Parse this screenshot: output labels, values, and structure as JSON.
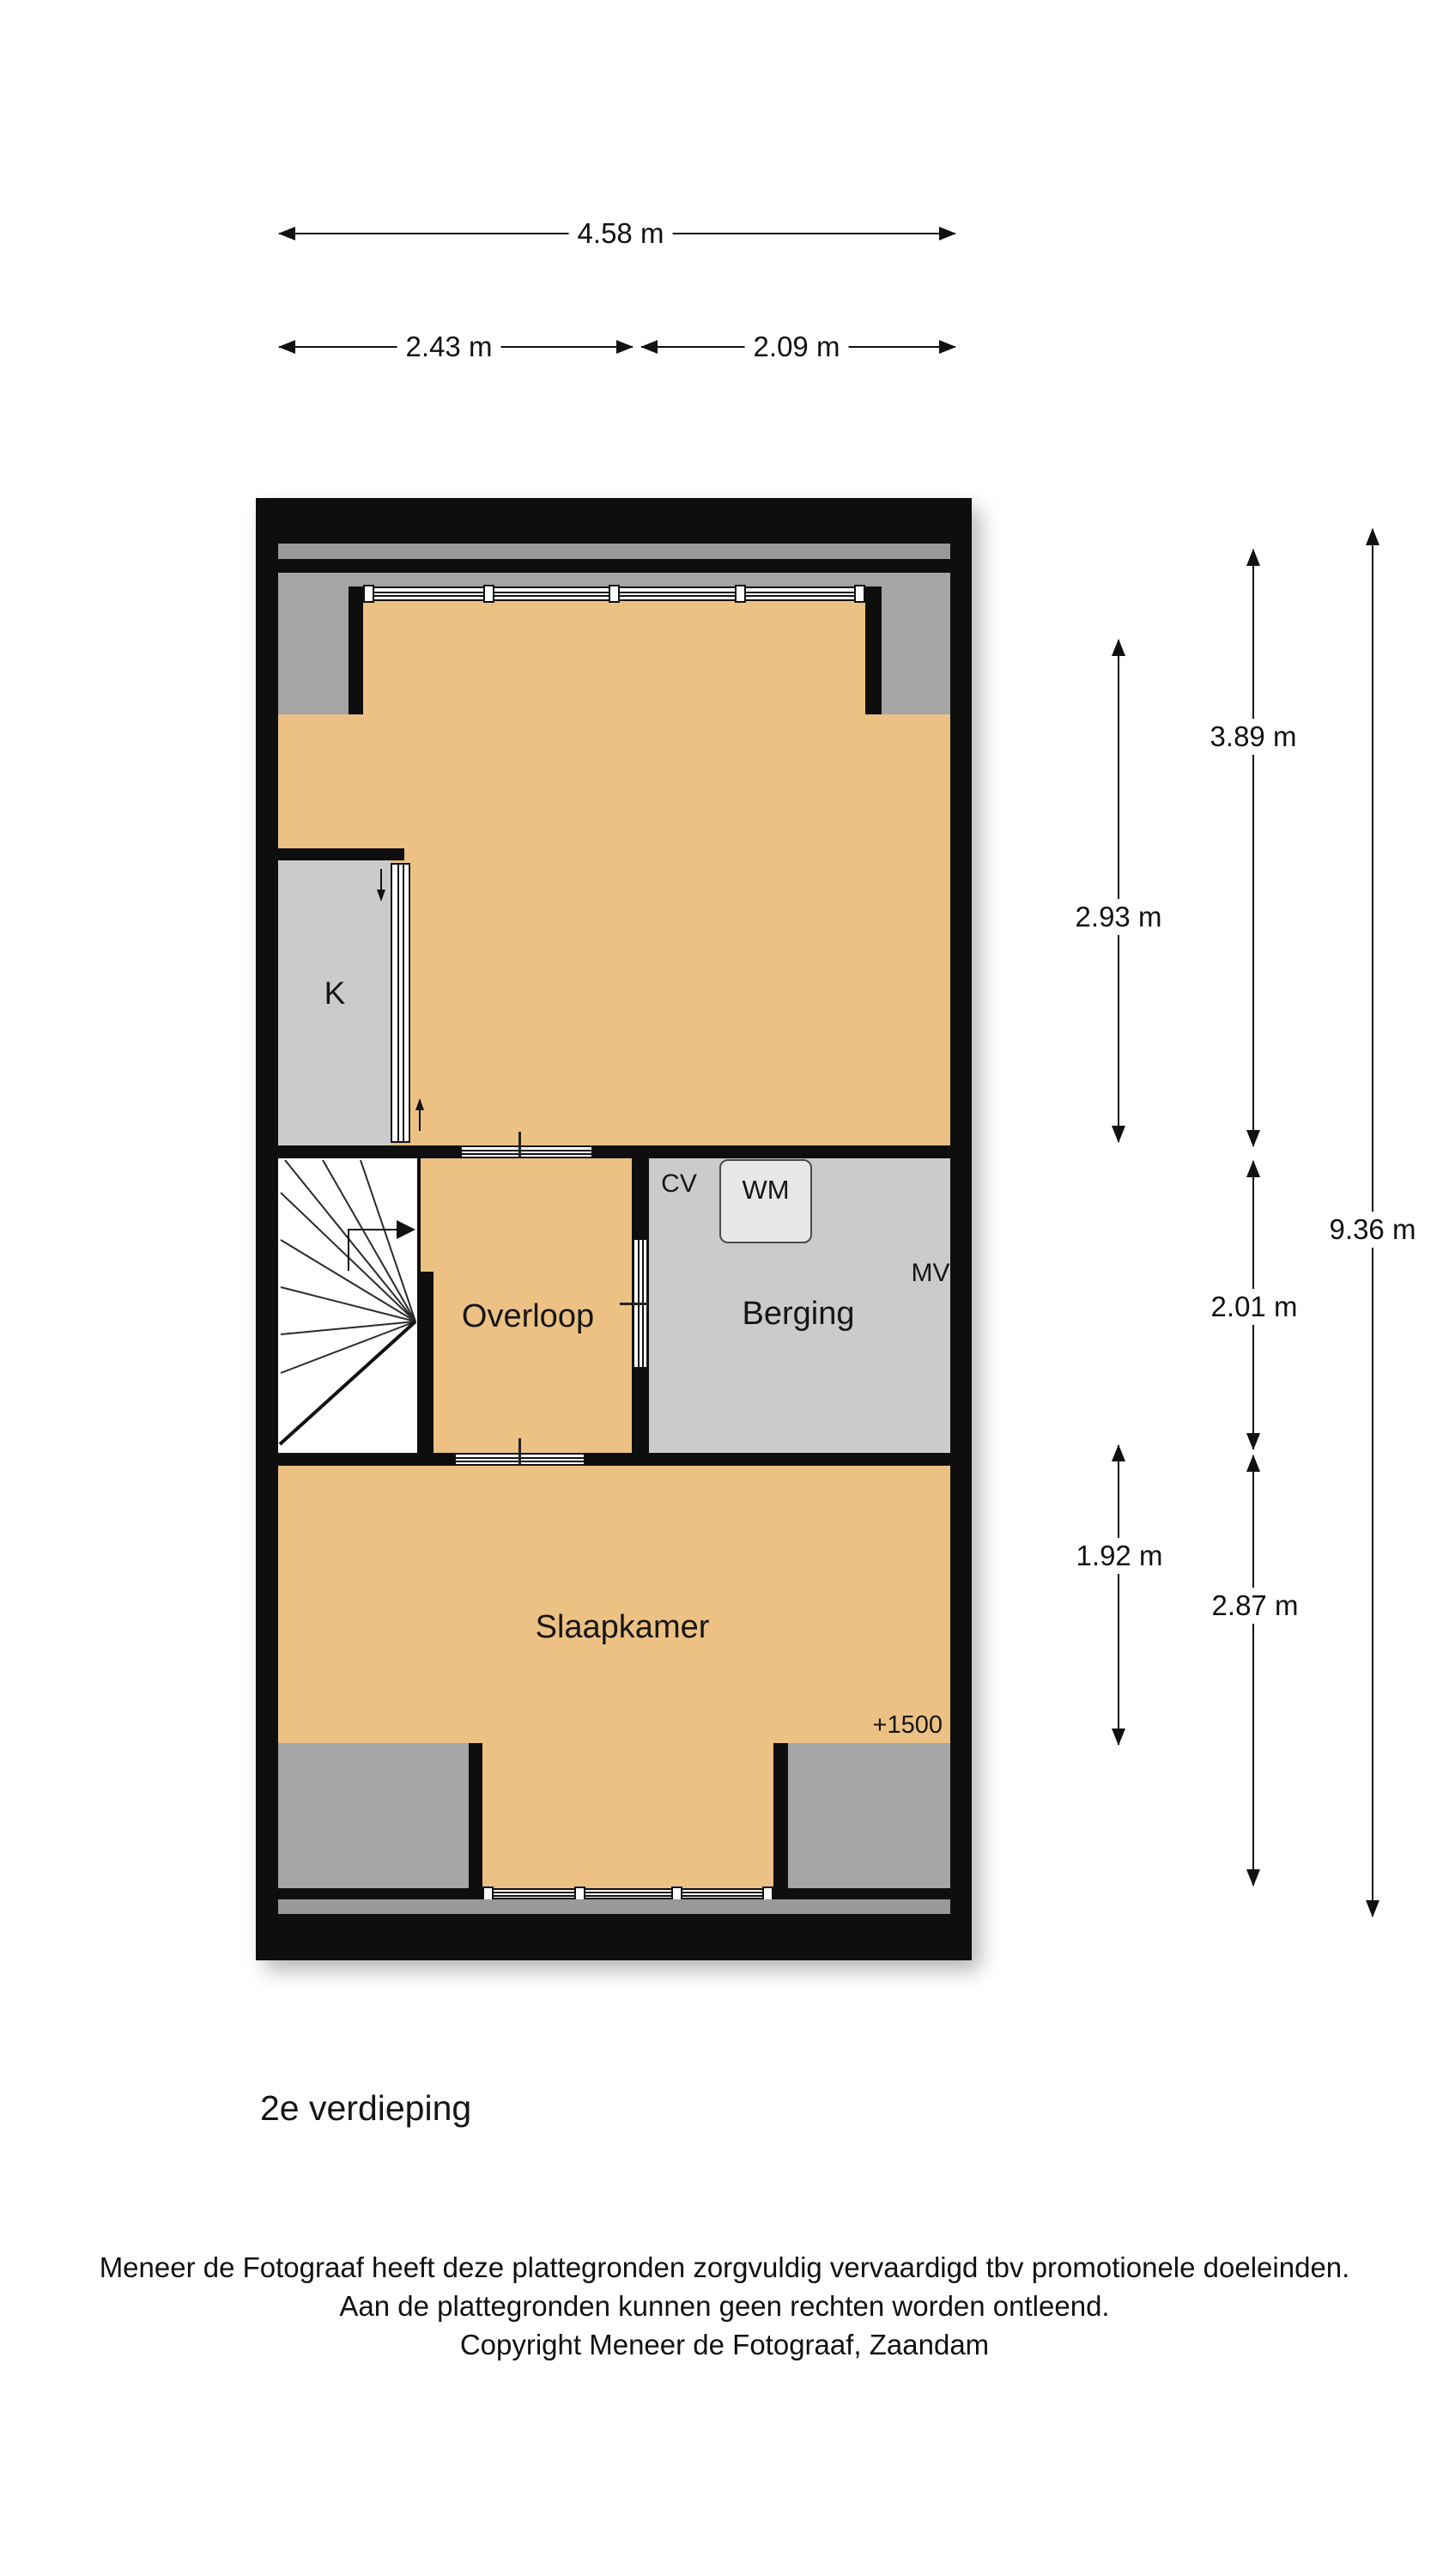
{
  "floor_title": "2e verdieping",
  "rooms": {
    "bedroom_top": "Slaapkamer",
    "closet": "K",
    "landing": "Overloop",
    "storage": "Berging",
    "bedroom_bottom": "Slaapkamer"
  },
  "appliances": {
    "washing_machine": "WM",
    "central_heating": "CV",
    "mechanical_ventilation": "MV"
  },
  "annotations": {
    "ceiling_height_top": "+1500",
    "ceiling_height_bottom": "+1500"
  },
  "dimensions": {
    "width_total": "4.58 m",
    "width_left": "2.43 m",
    "width_right": "2.09 m",
    "height_total": "9.36 m",
    "bedroom_top_inner": "2.93 m",
    "bedroom_top": "3.89 m",
    "landing": "2.01 m",
    "bedroom_bottom_inner": "1.92 m",
    "bedroom_bottom": "2.87 m"
  },
  "footer": {
    "line1": "Meneer de Fotograaf heeft deze plattegronden zorgvuldig vervaardigd tbv promotionele doeleinden.",
    "line2": "Aan de plattegronden kunnen geen rechten worden ontleend.",
    "line3": "Copyright Meneer de Fotograaf, Zaandam"
  },
  "colors": {
    "wall": "#0e0e0e",
    "floor": "#ecc183",
    "room_gray": "#cbcbcb",
    "low_zone_gray": "#a5a5a5",
    "band_gray": "#999999"
  }
}
